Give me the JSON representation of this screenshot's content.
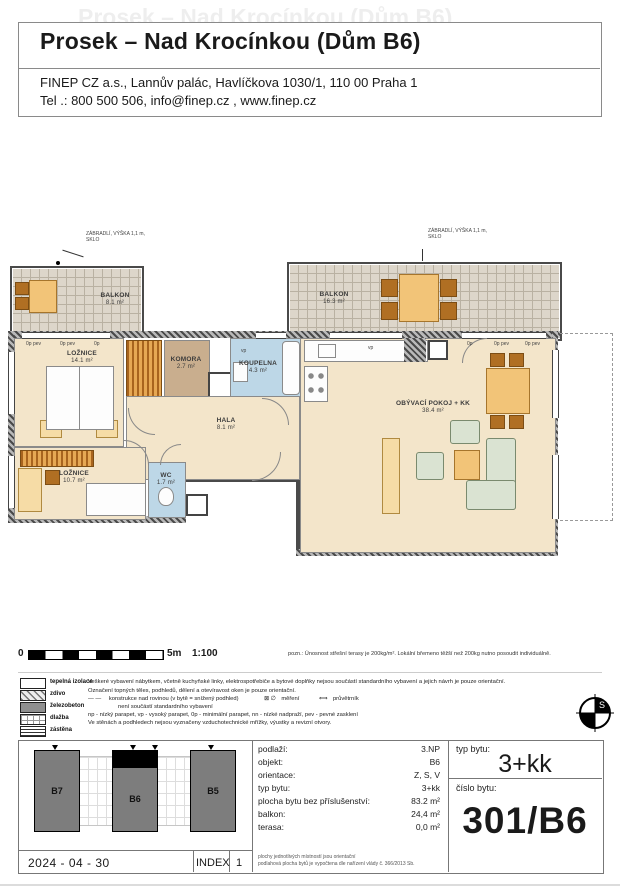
{
  "header": {
    "title": "Prosek – Nad Krocínkou (Dům B6)",
    "address": "FINEP CZ a.s., Lannův palác, Havlíčkova 1030/1, 110 00  Praha 1",
    "contact": "Tel .: 800 500 506, info@finep.cz , www.finep.cz"
  },
  "plan": {
    "railing": {
      "line1": "ZÁBRADLÍ, VÝŠKA 1,1 m,",
      "line2": "SKLO"
    },
    "balcony_left": {
      "name": "BALKON",
      "area": "8.1 m²"
    },
    "balcony_right": {
      "name": "BALKON",
      "area": "16.3 m²"
    },
    "rooms": {
      "loznice1": {
        "name": "LOŽNICE",
        "area": "14.1 m²"
      },
      "komora": {
        "name": "KOMORA",
        "area": "2.7 m²"
      },
      "koupelna": {
        "name": "KOUPELNA",
        "area": "4.3 m²"
      },
      "hala": {
        "name": "HALA",
        "area": "8.1 m²"
      },
      "loznice2": {
        "name": "LOŽNICE",
        "area": "10.7 m²"
      },
      "wc": {
        "name": "WC",
        "area": "1.7 m²"
      },
      "living": {
        "name": "OBÝVACÍ POKOJ + KK",
        "area": "38.4 m²"
      }
    },
    "window_labels": {
      "left1": "0p pev",
      "left2": "0p pev",
      "left3": "0p",
      "right1": "0p",
      "right2": "0p pev",
      "right3": "0p pev",
      "vp_bath": "vp",
      "vp_kitchen": "vp"
    }
  },
  "scale": {
    "zero": "0",
    "five": "5m",
    "ratio": "1:100"
  },
  "note": "pozn.: Únosnost střešní terasy je 200kg/m². Lokální břemeno těžší než 200kg nutno posoudit individuálně.",
  "legend": {
    "items": [
      {
        "label": "tepelná izolace"
      },
      {
        "label": "zdivo"
      },
      {
        "label": "železobeton"
      },
      {
        "label": "dlažba"
      },
      {
        "label": "zástěna"
      }
    ],
    "line1": "Veškeré vybavení nábytkem, včetně kuchyňské linky, elektrospotřebiče a bytové doplňky nejsou součástí standardního vybavení a jejich návrh je pouze orientační.",
    "line2": "Označení topných těles, podhledů, dělení a otevíravost oken je pouze orientační.",
    "line3_dash": "—  —",
    "line3a": "konstrukce nad rovinou (v bytě = snížený podhled)",
    "meter_icon": "⊠ ∅",
    "line3b": "měření",
    "vent_icon": "⟺",
    "line3c": "průvětrník",
    "line4": "není součástí standardního vybavení",
    "line5": "np - nízký parapet, vp - vysoký parapet, 0p - minimální parapet, nn - nízké nadpraží, pev - pevné zasklení",
    "line6": "Ve stěnách a podhledech nejsou vyznačeny vzduchotechnické mřížky, výustky a revizní otvory."
  },
  "compass": {
    "north": "S"
  },
  "site": {
    "buildings": [
      {
        "label": "B7"
      },
      {
        "label": "B6"
      },
      {
        "label": "B5"
      }
    ],
    "date": "2024 - 04 - 30",
    "index_label": "INDEX",
    "index_value": "1"
  },
  "info": {
    "rows": [
      {
        "label": "podlaží:",
        "value": "3.NP"
      },
      {
        "label": "objekt:",
        "value": "B6"
      },
      {
        "label": "orientace:",
        "value": "Z, S, V"
      },
      {
        "label": "typ bytu:",
        "value": "3+kk"
      },
      {
        "label": "plocha bytu bez příslušenství:",
        "value": "83.2 m²"
      },
      {
        "label": "balkon:",
        "value": "24,4 m²"
      },
      {
        "label": "terasa:",
        "value": "0,0 m²"
      }
    ],
    "fine1": "plochy jednotlivých místností jsou orientační",
    "fine2": "podlahová plocha bytů je vypočtena dle nařízení vlády č. 366/2013 Sb."
  },
  "unit": {
    "type_label": "typ bytu:",
    "type": "3+kk",
    "number_label": "číslo bytu:",
    "number": "301/B6"
  }
}
